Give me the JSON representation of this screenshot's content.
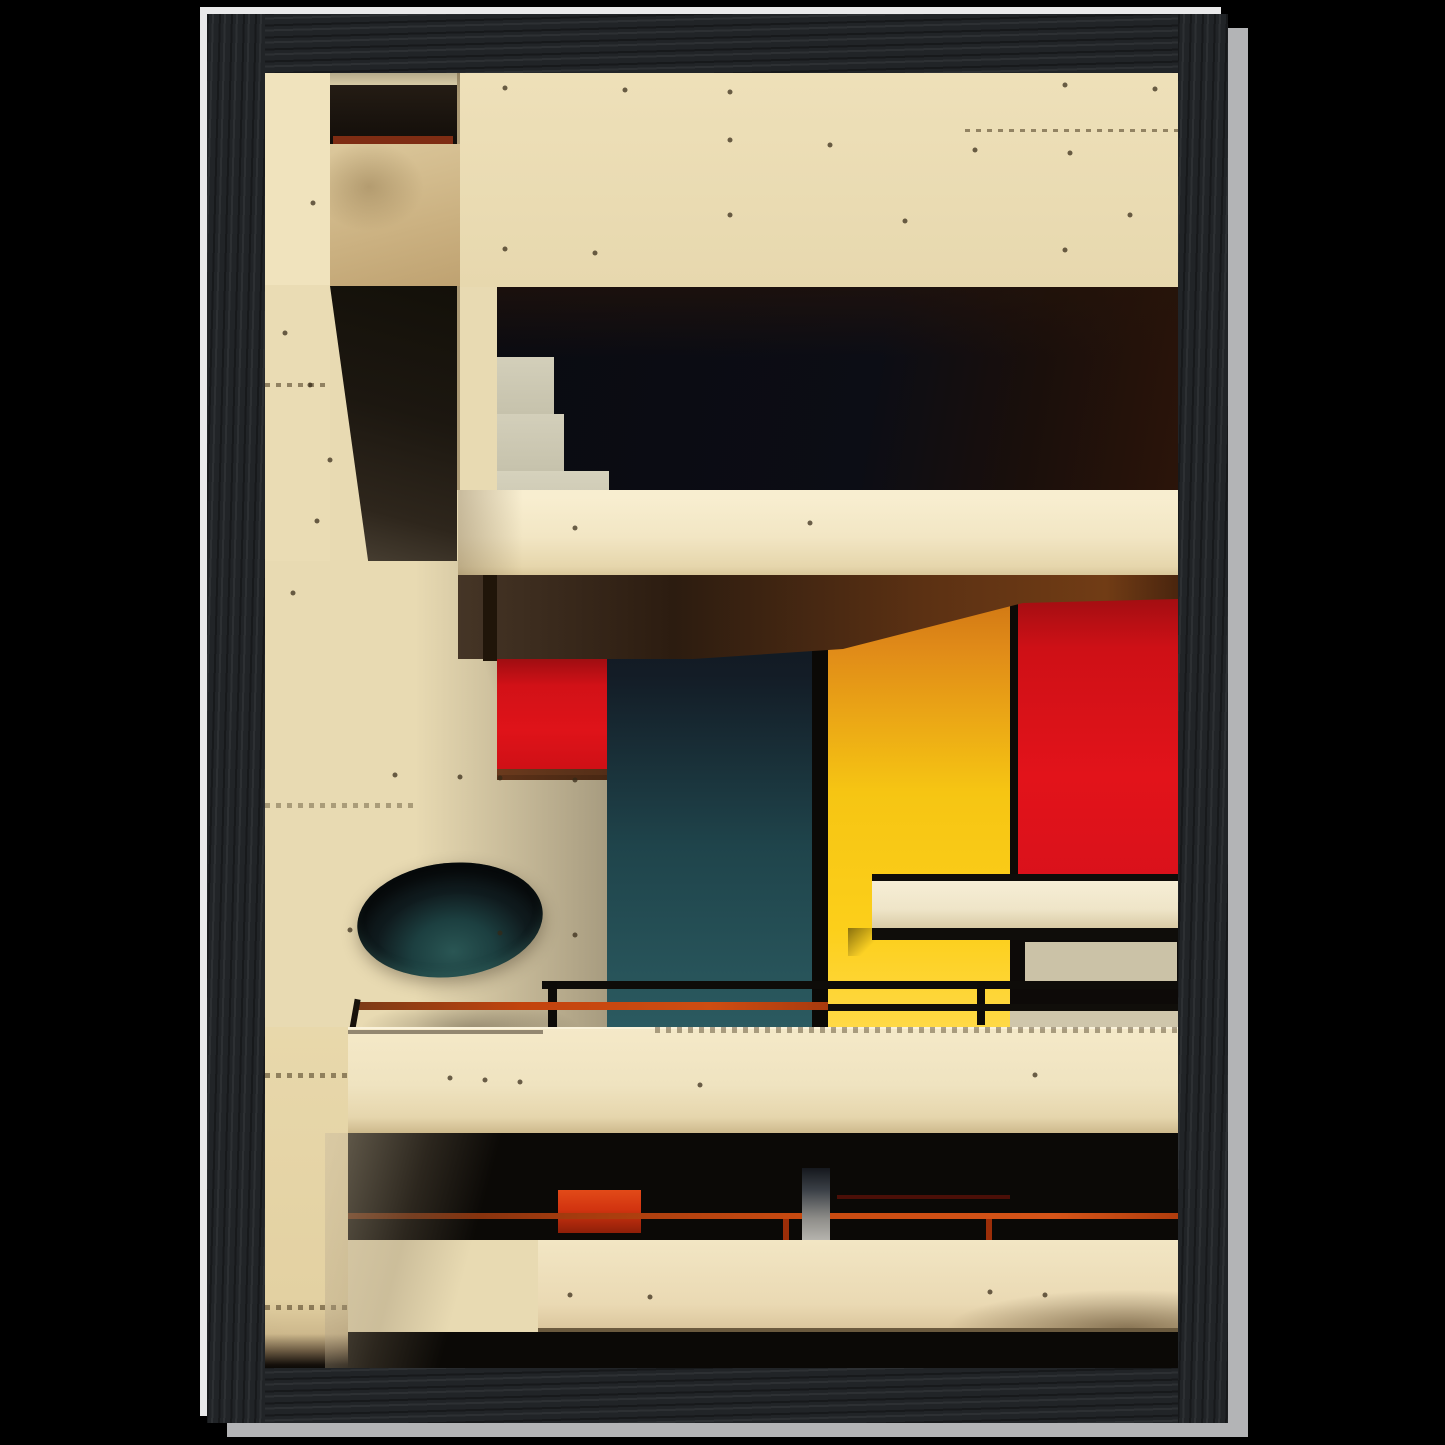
{
  "meta": {
    "kind": "framed-art-print-product-photo",
    "description": "Black wood-grain picture frame on a black background containing a Bauhaus-style architectural photograph: a modernist concrete facade with recessed balconies, primary color panels (red, yellow, teal), a dark porthole oval, white awning and rust-orange railings."
  },
  "frame": {
    "material": "black stained wood, visible grain",
    "highlight": "light gray keyline on left/top, wider light band on right/bottom"
  },
  "artwork": {
    "style": "Bauhaus / brutalist architecture photograph, warm sepia concrete tones",
    "elements": [
      "left concrete pier with form-tie holes and grime lines",
      "top-left recessed balcony with dark shadow band and red-brown rail",
      "grungy tan parapet block",
      "diagonal under-balcony shadow wedge",
      "large upper concrete wall",
      "recessed window band with gray glass panes and red panel",
      "double rust railing lines",
      "cream floor slab with dark soffit",
      "teal panel, yellow panel, red panel on recessed facade",
      "dark porthole oval with teal glow",
      "white horizontal awning",
      "middle balcony railings (black + rust orange)",
      "large cream parapet band",
      "dark recessed floor with red utility box, orange rail and gray pillar",
      "lower cream parapet band",
      "dark base shadow band"
    ],
    "palette": {
      "background": "#000000",
      "frame_wood": "#212427",
      "frame_wood_dark": "#17191b",
      "frame_wood_light": "#2d3033",
      "edge_highlight": "#e9e9ea",
      "edge_shadow": "#b3b4b6",
      "concrete": "#e8dab2",
      "concrete_light": "#f0e3bd",
      "cream_slab": "#f2e6c4",
      "parapet_tan": "#d2bd92",
      "shadow_black": "#0b0906",
      "opening_navy": "#0c0d15",
      "window_gray": "#cdc9b3",
      "red_upper": "#d21117",
      "red_main": "#e2131a",
      "yellow_main": "#f6c513",
      "orange_top": "#e08a18",
      "teal_panel": "#2b5a60",
      "navy_top": "#131c26",
      "rust_rail": "#c2430e",
      "soffit_brown": "#5c3113",
      "awning_white": "#f6eed6",
      "pillar_gray": "#b5b3ad"
    },
    "texture_dots": [
      [
        240,
        15
      ],
      [
        360,
        17
      ],
      [
        465,
        19
      ],
      [
        800,
        12
      ],
      [
        890,
        16
      ],
      [
        465,
        67
      ],
      [
        565,
        72
      ],
      [
        710,
        77
      ],
      [
        805,
        80
      ],
      [
        465,
        142
      ],
      [
        640,
        148
      ],
      [
        865,
        142
      ],
      [
        240,
        176
      ],
      [
        330,
        180
      ],
      [
        800,
        177
      ],
      [
        45,
        312
      ],
      [
        65,
        387
      ],
      [
        28,
        520
      ],
      [
        48,
        130
      ],
      [
        20,
        260
      ],
      [
        52,
        448
      ],
      [
        130,
        702
      ],
      [
        195,
        704
      ],
      [
        235,
        705
      ],
      [
        310,
        707
      ],
      [
        85,
        857
      ],
      [
        235,
        860
      ],
      [
        310,
        862
      ],
      [
        310,
        455
      ],
      [
        545,
        450
      ],
      [
        185,
        1005
      ],
      [
        220,
        1007
      ],
      [
        255,
        1009
      ],
      [
        435,
        1012
      ],
      [
        770,
        1002
      ],
      [
        305,
        1222
      ],
      [
        385,
        1224
      ],
      [
        725,
        1219
      ],
      [
        780,
        1222
      ]
    ]
  }
}
